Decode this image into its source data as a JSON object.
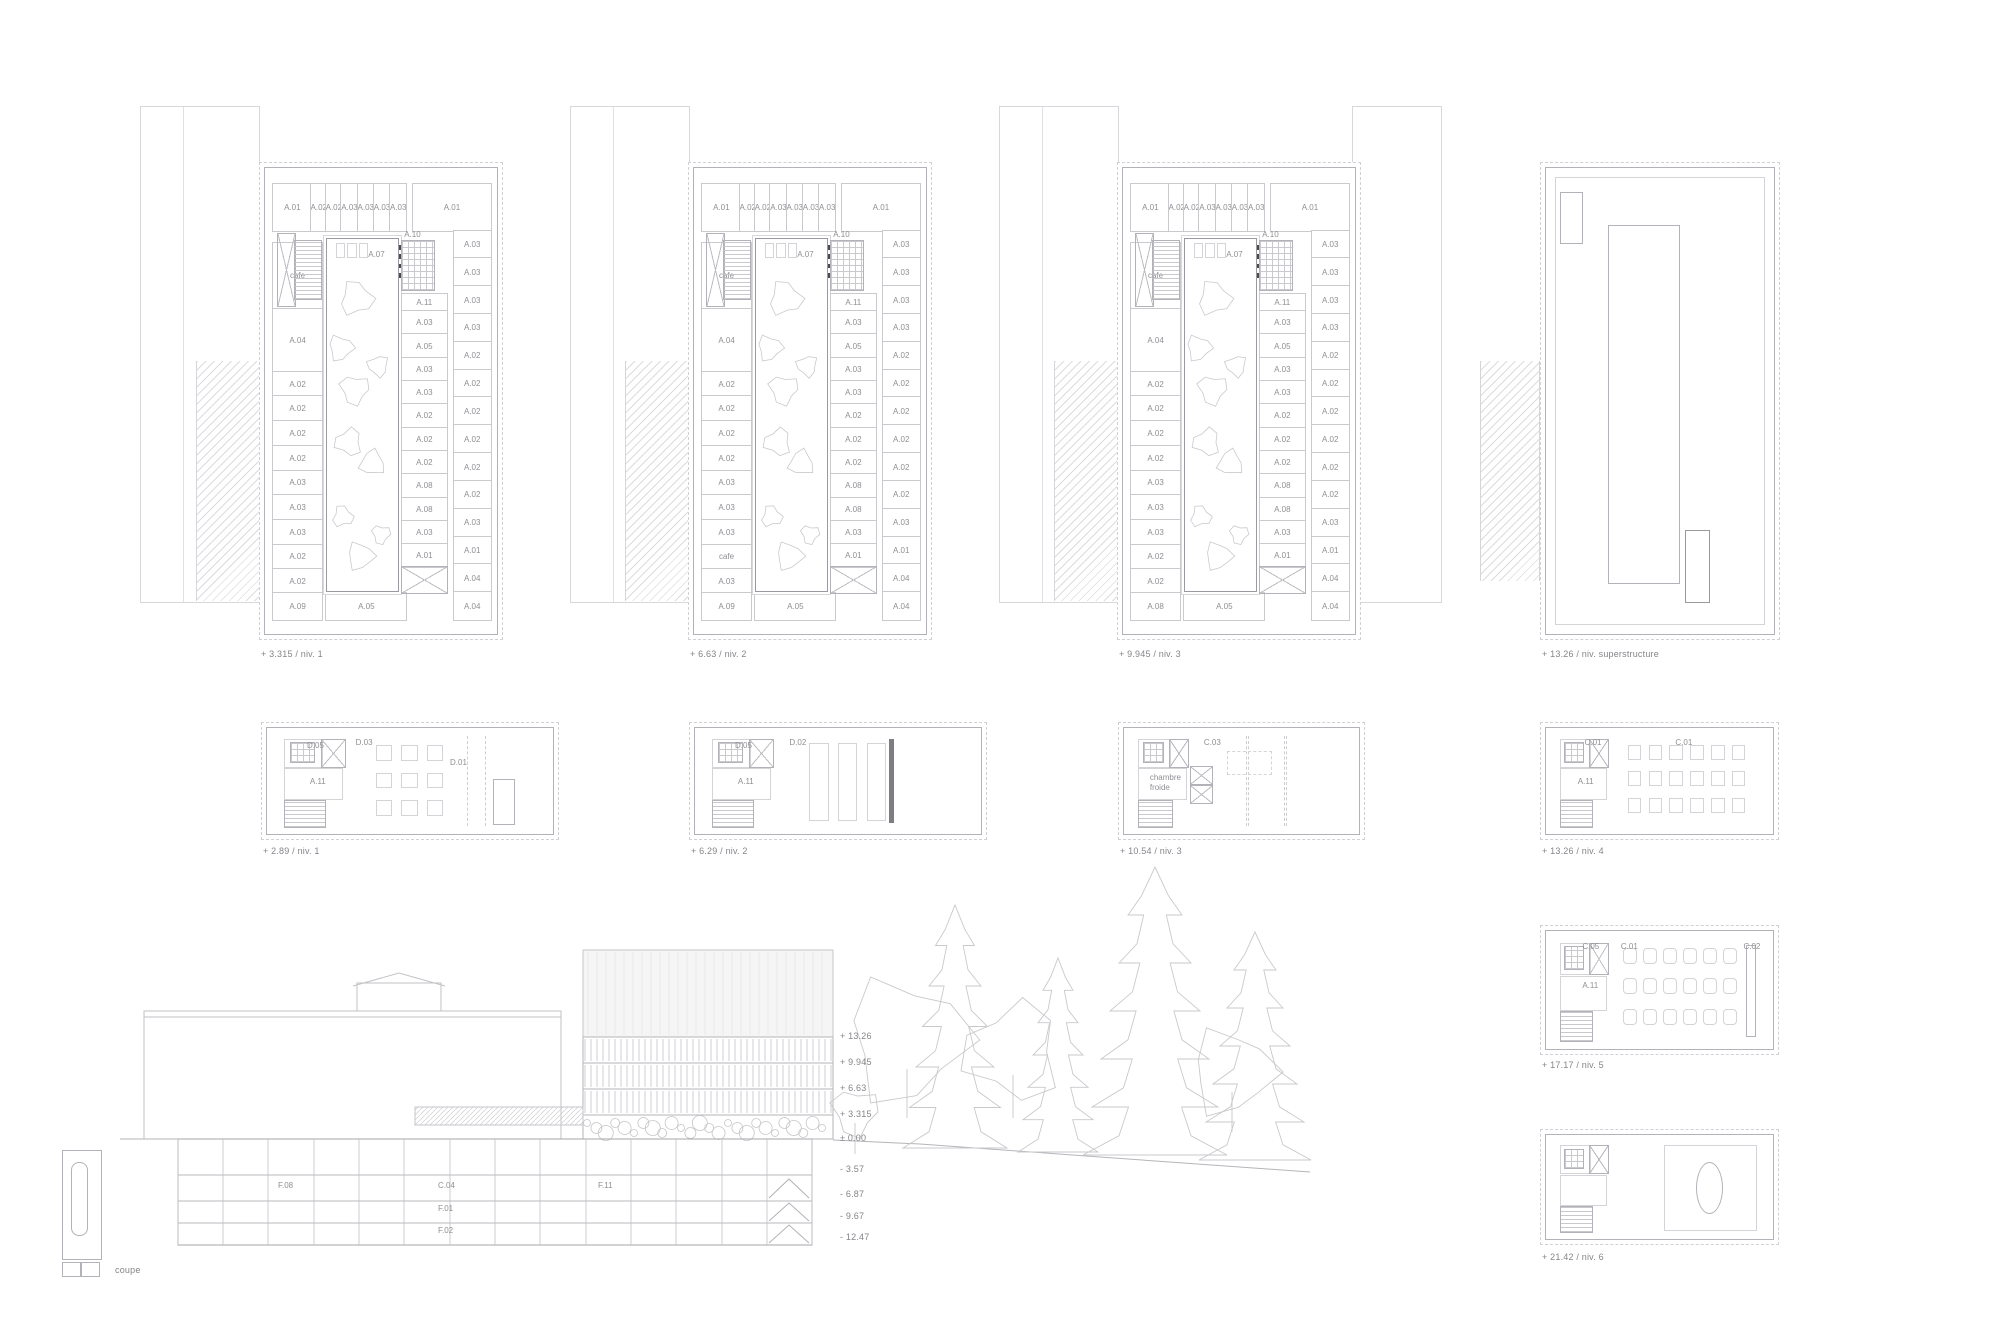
{
  "palette": {
    "line_light": "#d4d4d8",
    "line": "#b2b2b8",
    "line_dark": "#98989e",
    "label_text": "#8f8f94"
  },
  "top_plans": [
    {
      "caption": "+ 3.315 / niv. 1",
      "top_row": [
        "A.01",
        "A.02",
        "A.02",
        "A.03",
        "A.03",
        "A.03",
        "A.03",
        "A.01"
      ],
      "left_col": [
        "cafe",
        "A.04",
        "A.02",
        "A.02",
        "A.02",
        "A.02",
        "A.03",
        "A.03",
        "A.03",
        "A.02",
        "A.02"
      ],
      "inner_col": [
        "A.03",
        "A.05",
        "A.03",
        "A.03",
        "A.02",
        "A.02",
        "A.02",
        "A.08",
        "A.08",
        "A.03",
        "A.01"
      ],
      "outer_col": [
        "A.03",
        "A.03",
        "A.03",
        "A.03",
        "A.02",
        "A.02",
        "A.02",
        "A.02",
        "A.02",
        "A.02",
        "A.03",
        "A.01",
        "A.04",
        "A.04"
      ],
      "bottom_left": "A.09",
      "bottom_center": "A.05",
      "core_labels": {
        "furniture": "A.07",
        "elevator_core": "A.10",
        "hall": "A.11"
      }
    },
    {
      "caption": "+ 6.63 / niv. 2",
      "top_row": [
        "A.01",
        "A.02",
        "A.02",
        "A.03",
        "A.03",
        "A.03",
        "A.03",
        "A.01"
      ],
      "left_col": [
        "cafe",
        "A.04",
        "A.02",
        "A.02",
        "A.02",
        "A.02",
        "A.03",
        "A.03",
        "A.03",
        "cafe",
        "A.03"
      ],
      "inner_col": [
        "A.03",
        "A.05",
        "A.03",
        "A.03",
        "A.02",
        "A.02",
        "A.02",
        "A.08",
        "A.08",
        "A.03",
        "A.01"
      ],
      "outer_col": [
        "A.03",
        "A.03",
        "A.03",
        "A.03",
        "A.02",
        "A.02",
        "A.02",
        "A.02",
        "A.02",
        "A.02",
        "A.03",
        "A.01",
        "A.04",
        "A.04"
      ],
      "bottom_left": "A.09",
      "bottom_center": "A.05",
      "core_labels": {
        "furniture": "A.07",
        "elevator_core": "A.10",
        "hall": "A.11"
      }
    },
    {
      "caption": "+ 9.945 / niv. 3",
      "top_row": [
        "A.01",
        "A.02",
        "A.02",
        "A.03",
        "A.03",
        "A.03",
        "A.03",
        "A.01"
      ],
      "left_col": [
        "cafe",
        "A.04",
        "A.02",
        "A.02",
        "A.02",
        "A.02",
        "A.03",
        "A.03",
        "A.03",
        "A.02",
        "A.02"
      ],
      "inner_col": [
        "A.03",
        "A.05",
        "A.03",
        "A.03",
        "A.02",
        "A.02",
        "A.02",
        "A.08",
        "A.08",
        "A.03",
        "A.01"
      ],
      "outer_col": [
        "A.03",
        "A.03",
        "A.03",
        "A.03",
        "A.02",
        "A.02",
        "A.02",
        "A.02",
        "A.02",
        "A.02",
        "A.03",
        "A.01",
        "A.04",
        "A.04"
      ],
      "bottom_left": "A.08",
      "bottom_center": "A.05",
      "core_labels": {
        "furniture": "A.07",
        "elevator_core": "A.10",
        "hall": "A.11"
      }
    }
  ],
  "roof_plan": {
    "caption": "+ 13.26 / niv. superstructure"
  },
  "mid_plans": [
    {
      "caption": "+ 2.89 / niv. 1",
      "labels": [
        {
          "text": "D.05",
          "x": 14,
          "y": 12
        },
        {
          "text": "D.03",
          "x": 31,
          "y": 9
        },
        {
          "text": "A.11",
          "x": 15,
          "y": 46
        },
        {
          "text": "D.01",
          "x": 64,
          "y": 28
        }
      ]
    },
    {
      "caption": "+ 6.29 / niv. 2",
      "labels": [
        {
          "text": "D.05",
          "x": 14,
          "y": 12
        },
        {
          "text": "D.02",
          "x": 33,
          "y": 9
        },
        {
          "text": "A.11",
          "x": 15,
          "y": 46
        }
      ]
    },
    {
      "caption": "+ 10.54 / niv. 3",
      "labels": [
        {
          "text": "C.03",
          "x": 34,
          "y": 9
        },
        {
          "text": "chambre froide",
          "x": 11,
          "y": 42
        }
      ]
    },
    {
      "caption": "+ 13.26 / niv. 4",
      "labels": [
        {
          "text": "C.01",
          "x": 17,
          "y": 9
        },
        {
          "text": "C.01",
          "x": 57,
          "y": 9
        },
        {
          "text": "A.11",
          "x": 14,
          "y": 46
        }
      ]
    }
  ],
  "right_plans": [
    {
      "caption": "+ 17.17 / niv. 5",
      "labels": [
        {
          "text": "C.05",
          "x": 16,
          "y": 9
        },
        {
          "text": "C.01",
          "x": 33,
          "y": 9
        },
        {
          "text": "C.02",
          "x": 87,
          "y": 9
        },
        {
          "text": "A.11",
          "x": 16,
          "y": 42
        }
      ]
    },
    {
      "caption": "+ 21.42 / niv. 6",
      "labels": []
    }
  ],
  "section": {
    "key_label": "coupe",
    "elevations": [
      {
        "text": "+ 13.26",
        "x": 840,
        "y": 1031
      },
      {
        "text": "+ 9.945",
        "x": 840,
        "y": 1057
      },
      {
        "text": "+ 6.63",
        "x": 840,
        "y": 1083
      },
      {
        "text": "+ 3.315",
        "x": 840,
        "y": 1109
      },
      {
        "text": "± 0.00",
        "x": 840,
        "y": 1133
      },
      {
        "text": "- 3.57",
        "x": 840,
        "y": 1164
      },
      {
        "text": "- 6.87",
        "x": 840,
        "y": 1189
      },
      {
        "text": "- 9.67",
        "x": 840,
        "y": 1211
      },
      {
        "text": "- 12.47",
        "x": 840,
        "y": 1232
      }
    ],
    "basement_rooms": [
      {
        "text": "F.08",
        "x": 278,
        "y": 1181
      },
      {
        "text": "C.04",
        "x": 438,
        "y": 1181
      },
      {
        "text": "F.11",
        "x": 598,
        "y": 1181
      },
      {
        "text": "F.01",
        "x": 438,
        "y": 1204
      },
      {
        "text": "F.02",
        "x": 438,
        "y": 1226
      }
    ]
  }
}
